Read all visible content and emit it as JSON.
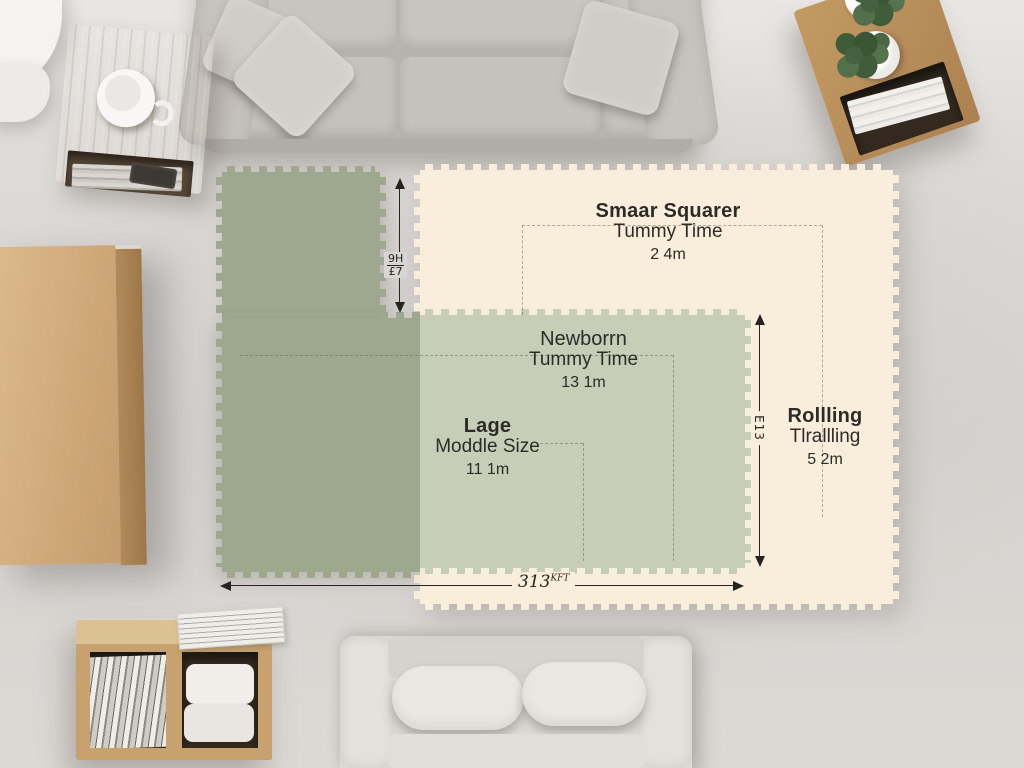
{
  "scene": {
    "description": "Top-down living room photo with interlocking foam play-mat size comparison overlay"
  },
  "mats": {
    "small_square": {
      "name_bold": "Smaar Squarer",
      "name_sub": "Tummy Time",
      "size": "2 4m"
    },
    "newborn": {
      "name_top": "Newborrn",
      "name_sub": "Tummy Time",
      "size": "13 1m"
    },
    "large": {
      "name_bold": "Lage",
      "name_sub": "Moddle Size",
      "size": "11 1m"
    },
    "rolling": {
      "name_bold": "Rollling",
      "name_sub": "Tlrallling",
      "size": "5 2m"
    }
  },
  "dimensions": {
    "gap_top": "9H",
    "gap_bottom": "£7",
    "right_height": "E13",
    "bottom_width_value": "313",
    "bottom_width_unit": "KFT"
  },
  "colors": {
    "mat_cream": "#f8eedb",
    "mat_sage": "#9ea88f",
    "mat_sage_overlap": "#c6ceb7",
    "floor": "#d8d6d4",
    "wood": "#c9a36f",
    "text": "#2c2a26",
    "arrow": "#26241f"
  }
}
